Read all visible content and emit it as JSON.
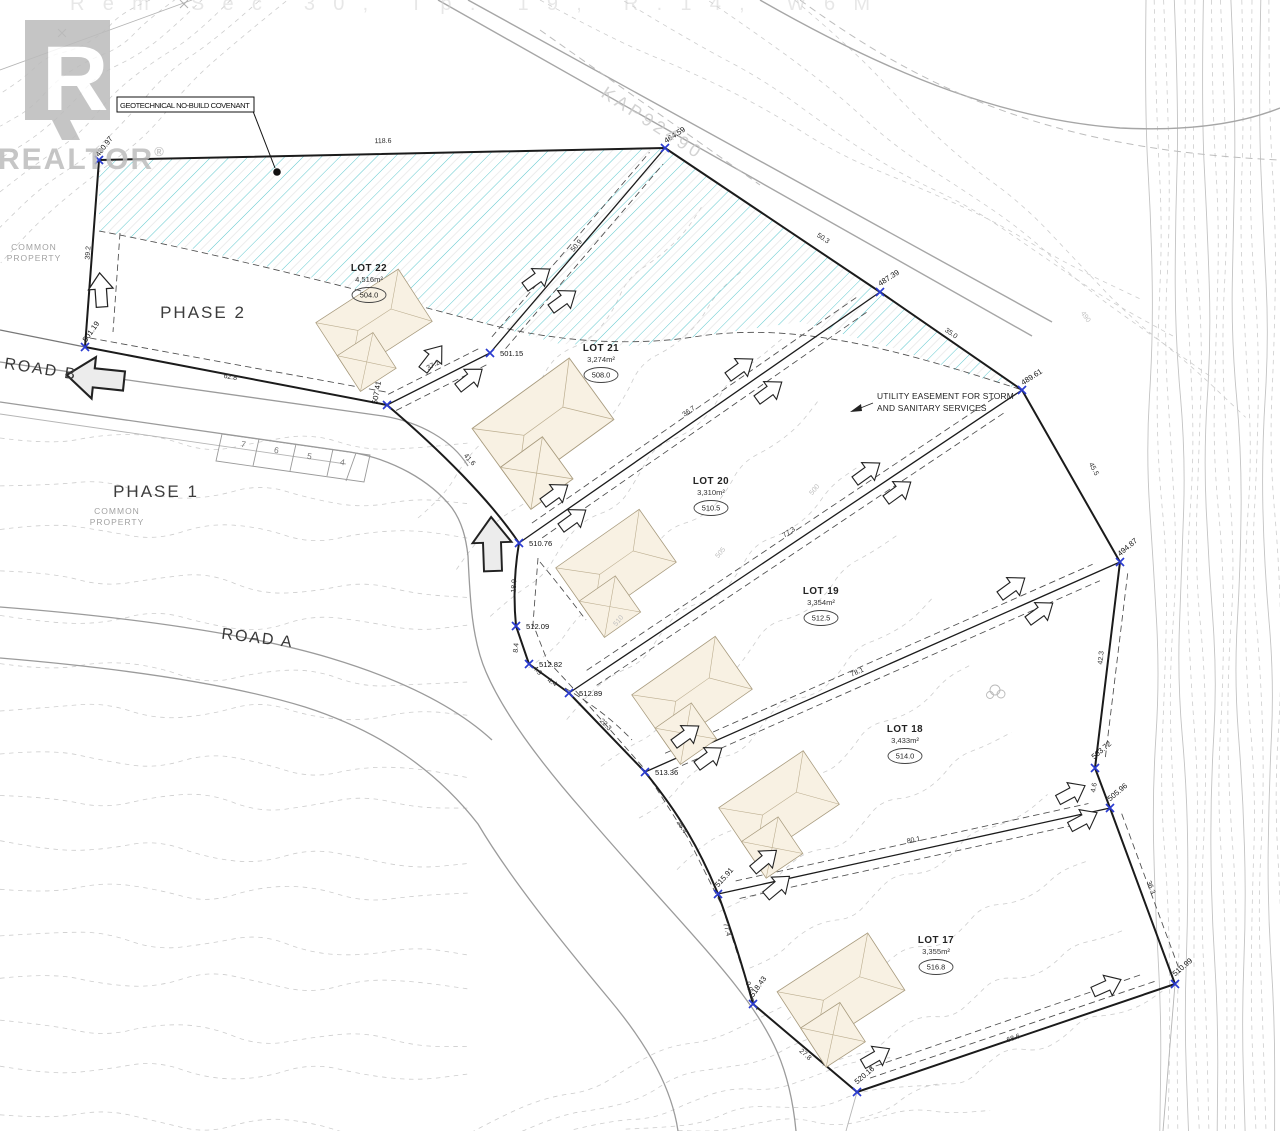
{
  "annotations": {
    "covenant": "GEOTECHNICAL NO-BUILD COVENANT",
    "utility_line1": "UTILITY EASEMENT FOR STORM",
    "utility_line2": "AND SANITARY SERVICES"
  },
  "watermark": {
    "logo_letter": "R",
    "brand": "REALTOR",
    "registered": "®"
  },
  "background_text": {
    "legal": "Rem Sec 30, Tp. 19, R.14, W6M",
    "plan_ref": "KAP92490"
  },
  "area_labels": {
    "phases": [
      {
        "t": "PHASE 2",
        "x": 203,
        "y": 318
      },
      {
        "t": "PHASE 1",
        "x": 156,
        "y": 497
      }
    ],
    "roads": [
      {
        "t": "ROAD B",
        "x": 40,
        "y": 374,
        "r": 9
      },
      {
        "t": "ROAD A",
        "x": 257,
        "y": 643,
        "r": 7
      }
    ],
    "common_positions": [
      {
        "x": 34,
        "y": 250
      },
      {
        "x": 117,
        "y": 514
      }
    ],
    "common_lines": [
      "COMMON",
      "PROPERTY"
    ]
  },
  "lots": [
    {
      "name": "LOT 22",
      "area": "4,516m²",
      "elev": "504.0",
      "x": 369,
      "y": 271
    },
    {
      "name": "LOT 21",
      "area": "3,274m²",
      "elev": "508.0",
      "x": 601,
      "y": 351
    },
    {
      "name": "LOT 20",
      "area": "3,310m²",
      "elev": "510.5",
      "x": 711,
      "y": 484
    },
    {
      "name": "LOT 19",
      "area": "3,354m²",
      "elev": "512.5",
      "x": 821,
      "y": 594
    },
    {
      "name": "LOT 18",
      "area": "3,433m²",
      "elev": "514.0",
      "x": 905,
      "y": 732
    },
    {
      "name": "LOT 17",
      "area": "3,355m²",
      "elev": "516.8",
      "x": 936,
      "y": 943
    }
  ],
  "markers": [
    {
      "v": "480.97",
      "x": 99,
      "y": 160,
      "lx": 106,
      "ly": 148,
      "lr": -52
    },
    {
      "v": "464.59",
      "x": 665,
      "y": 148,
      "lx": 676,
      "ly": 137,
      "lr": -33
    },
    {
      "v": "487.39",
      "x": 880,
      "y": 292,
      "lx": 890,
      "ly": 280,
      "lr": -33
    },
    {
      "v": "489.61",
      "x": 1022,
      "y": 390,
      "lx": 1033,
      "ly": 379,
      "lr": -33
    },
    {
      "v": "494.87",
      "x": 1120,
      "y": 562,
      "lx": 1129,
      "ly": 549,
      "lr": -40
    },
    {
      "v": "503.72",
      "x": 1095,
      "y": 768,
      "lx": 1103,
      "ly": 752,
      "lr": -40
    },
    {
      "v": "505.96",
      "x": 1110,
      "y": 808,
      "lx": 1119,
      "ly": 794,
      "lr": -40
    },
    {
      "v": "510.99",
      "x": 1175,
      "y": 984,
      "lx": 1184,
      "ly": 969,
      "lr": -40
    },
    {
      "v": "520.16",
      "x": 857,
      "y": 1092,
      "lx": 866,
      "ly": 1077,
      "lr": -40
    },
    {
      "v": "518.43",
      "x": 753,
      "y": 1004,
      "lx": 760,
      "ly": 988,
      "lr": -55
    },
    {
      "v": "515.91",
      "x": 718,
      "y": 894,
      "lx": 726,
      "ly": 879,
      "lr": -48
    },
    {
      "v": "513.36",
      "x": 645,
      "y": 772,
      "lx": 655,
      "ly": 775,
      "lr": 0,
      "a": "start"
    },
    {
      "v": "512.89",
      "x": 569,
      "y": 693,
      "lx": 579,
      "ly": 696,
      "lr": 0,
      "a": "start"
    },
    {
      "v": "512.82",
      "x": 529,
      "y": 664,
      "lx": 539,
      "ly": 667,
      "lr": 0,
      "a": "start"
    },
    {
      "v": "512.09",
      "x": 516,
      "y": 626,
      "lx": 526,
      "ly": 629,
      "lr": 0,
      "a": "start"
    },
    {
      "v": "510.76",
      "x": 519,
      "y": 543,
      "lx": 529,
      "ly": 546,
      "lr": 0,
      "a": "start"
    },
    {
      "v": "507.41",
      "x": 387,
      "y": 405,
      "lx": 379,
      "ly": 393,
      "lr": -80
    },
    {
      "v": "501.15",
      "x": 490,
      "y": 353,
      "lx": 500,
      "ly": 356,
      "lr": 0,
      "a": "start"
    },
    {
      "v": "501.19",
      "x": 85,
      "y": 347,
      "lx": 93,
      "ly": 333,
      "lr": -55
    }
  ],
  "dimensions": [
    {
      "v": "118.6",
      "x": 383,
      "y": 143,
      "r": -1
    },
    {
      "v": "50.9",
      "x": 578,
      "y": 247,
      "r": -50
    },
    {
      "v": "50.3",
      "x": 822,
      "y": 240,
      "r": 34
    },
    {
      "v": "35.0",
      "x": 950,
      "y": 335,
      "r": 35
    },
    {
      "v": "45.5",
      "x": 1092,
      "y": 470,
      "r": 62
    },
    {
      "v": "42.3",
      "x": 1103,
      "y": 658,
      "r": -84
    },
    {
      "v": "4.6",
      "x": 1096,
      "y": 788,
      "r": -80
    },
    {
      "v": "36.3",
      "x": 1149,
      "y": 888,
      "r": 70
    },
    {
      "v": "68.6",
      "x": 1014,
      "y": 1040,
      "r": -19
    },
    {
      "v": "27.8",
      "x": 804,
      "y": 1056,
      "r": 42
    },
    {
      "v": "0.9",
      "x": 747,
      "y": 987,
      "r": 72
    },
    {
      "v": "77.4",
      "x": 725,
      "y": 930,
      "r": 74
    },
    {
      "v": "25.4",
      "x": 680,
      "y": 828,
      "r": 58
    },
    {
      "v": "22.3",
      "x": 604,
      "y": 726,
      "r": 46
    },
    {
      "v": "4.4",
      "x": 551,
      "y": 684,
      "r": 32
    },
    {
      "v": "4.9",
      "x": 536,
      "y": 672,
      "r": 48
    },
    {
      "v": "8.4",
      "x": 518,
      "y": 648,
      "r": -85
    },
    {
      "v": "18.9",
      "x": 516,
      "y": 586,
      "r": -87
    },
    {
      "v": "41.6",
      "x": 468,
      "y": 461,
      "r": 48
    },
    {
      "v": "62.8",
      "x": 230,
      "y": 379,
      "r": 11
    },
    {
      "v": "37.2",
      "x": 434,
      "y": 367,
      "r": -28
    },
    {
      "v": "39.2",
      "x": 90,
      "y": 253,
      "r": -86
    },
    {
      "v": "36.7",
      "x": 690,
      "y": 413,
      "r": -35
    },
    {
      "v": "77.3",
      "x": 790,
      "y": 534,
      "r": -34
    },
    {
      "v": "78.1",
      "x": 858,
      "y": 674,
      "r": -24
    },
    {
      "v": "80.1",
      "x": 914,
      "y": 842,
      "r": -13
    }
  ],
  "contour_labels": [
    {
      "v": "490",
      "x": 1084,
      "y": 318,
      "r": 55
    },
    {
      "v": "500",
      "x": 816,
      "y": 491,
      "r": -50
    },
    {
      "v": "505",
      "x": 722,
      "y": 554,
      "r": -50
    },
    {
      "v": "510",
      "x": 620,
      "y": 622,
      "r": -50
    }
  ],
  "parking_stalls": [
    {
      "n": "7",
      "x": 243,
      "y": 447
    },
    {
      "n": "6",
      "x": 276,
      "y": 453
    },
    {
      "n": "5",
      "x": 309,
      "y": 459
    },
    {
      "n": "4",
      "x": 342,
      "y": 465
    }
  ],
  "colors": {
    "hatch": "#5fc8ce",
    "boundary": "#1b1b1b",
    "marker": "#2a3bd0",
    "contour": "#cdcdcd",
    "house_fill": "#f8f1e3",
    "road": "#9b9b9b",
    "watermark": "#bcbcbc"
  }
}
